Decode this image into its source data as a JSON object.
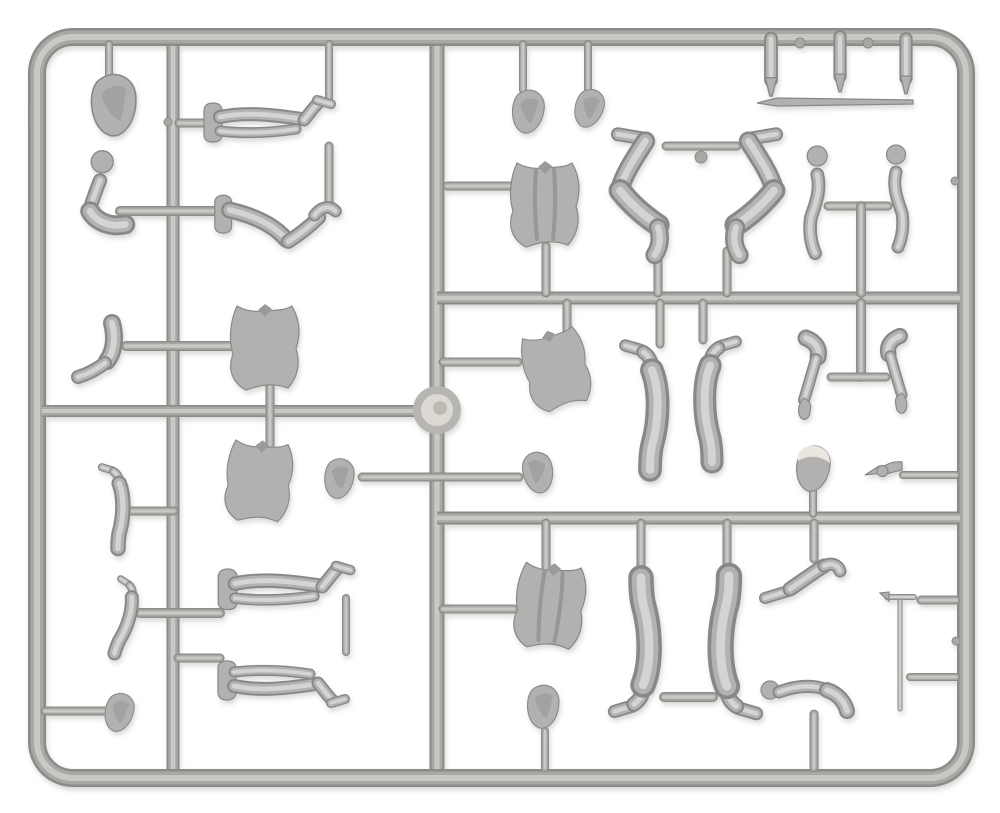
{
  "meta": {
    "title": "Gray plastic model-kit sprue with miniature figure parts",
    "scene_type": "photograph",
    "background_color": "#ffffff"
  },
  "canvas": {
    "width": 1000,
    "height": 813
  },
  "palette": {
    "runner_dark": "#8c8b89",
    "runner_mid": "#a9a8a5",
    "runner_core": "#c9c8c5",
    "part_dark": "#898886",
    "part_mid": "#b3b2b0",
    "part_core": "#d5d4d2",
    "part_fill": "#b2b1af",
    "part_outline": "#8a8987",
    "cap_light": "#eae8e0",
    "disc_ring": "#b6b5b1",
    "disc_center": "#dbd9d1",
    "disc_swirl": "#bdbab0",
    "strap_shade": "#989795",
    "collar_shade": "#9b9a98"
  },
  "frame": {
    "x": 37,
    "y": 37,
    "width": 929,
    "height": 741,
    "radius": 36,
    "thickness": 18
  },
  "runners": [
    {
      "name": "runner-vertical-left",
      "x1": 173,
      "y1": 46,
      "x2": 173,
      "y2": 769,
      "w": 13
    },
    {
      "name": "runner-vertical-center",
      "x1": 437,
      "y1": 46,
      "x2": 437,
      "y2": 769,
      "w": 15
    },
    {
      "name": "runner-horizontal-left-mid",
      "x1": 42,
      "y1": 411,
      "x2": 437,
      "y2": 411,
      "w": 12
    },
    {
      "name": "runner-horizontal-right-upper",
      "x1": 437,
      "y1": 298,
      "x2": 960,
      "y2": 298,
      "w": 13
    },
    {
      "name": "runner-horizontal-right-lower",
      "x1": 437,
      "y1": 518,
      "x2": 960,
      "y2": 518,
      "w": 13
    },
    {
      "name": "gate-arm-left",
      "x1": 120,
      "y1": 211,
      "x2": 222,
      "y2": 211,
      "w": 10,
      "cap": 1
    },
    {
      "name": "gate-boot-torso-left",
      "x1": 126,
      "y1": 346,
      "x2": 230,
      "y2": 346,
      "w": 10,
      "cap": 1
    },
    {
      "name": "gate-legs1-waist",
      "x1": 179,
      "y1": 123,
      "x2": 209,
      "y2": 123,
      "w": 9,
      "cap": 1
    },
    {
      "name": "gate-boot2-left",
      "x1": 122,
      "y1": 511,
      "x2": 174,
      "y2": 511,
      "w": 9,
      "cap": 1
    },
    {
      "name": "gate-legs3-left",
      "x1": 140,
      "y1": 613,
      "x2": 220,
      "y2": 613,
      "w": 10,
      "cap": 1
    },
    {
      "name": "gate-legs4-left",
      "x1": 178,
      "y1": 658,
      "x2": 220,
      "y2": 658,
      "w": 9,
      "cap": 1
    },
    {
      "name": "gate-head-bottom-left",
      "x1": 45,
      "y1": 711,
      "x2": 106,
      "y2": 711,
      "w": 9,
      "cap": 1
    },
    {
      "name": "gate-hooded-head",
      "x1": 109,
      "y1": 44,
      "x2": 109,
      "y2": 76,
      "w": 8,
      "cap": 1
    },
    {
      "name": "gate-legs1-boot-top",
      "x1": 329,
      "y1": 44,
      "x2": 329,
      "y2": 101,
      "w": 8,
      "cap": 1
    },
    {
      "name": "link-legs1-legs2",
      "x1": 329,
      "y1": 146,
      "x2": 329,
      "y2": 204,
      "w": 9,
      "cap": 1
    },
    {
      "name": "gate-torso1-torso2",
      "x1": 270,
      "y1": 386,
      "x2": 270,
      "y2": 450,
      "w": 9,
      "cap": 1
    },
    {
      "name": "link-legs3-legs4",
      "x1": 346,
      "y1": 598,
      "x2": 346,
      "y2": 652,
      "w": 8,
      "cap": 1
    },
    {
      "name": "rod-center-heads",
      "x1": 362,
      "y1": 477,
      "x2": 519,
      "y2": 477,
      "w": 9,
      "cap": 1
    },
    {
      "name": "gate-head1-top",
      "x1": 523,
      "y1": 44,
      "x2": 523,
      "y2": 90,
      "w": 8,
      "cap": 1
    },
    {
      "name": "gate-head2-top",
      "x1": 588,
      "y1": 44,
      "x2": 588,
      "y2": 90,
      "w": 8,
      "cap": 1
    },
    {
      "name": "gate-vest-torso",
      "x1": 447,
      "y1": 186,
      "x2": 513,
      "y2": 186,
      "w": 9,
      "cap": 1
    },
    {
      "name": "gate-vest-down",
      "x1": 546,
      "y1": 246,
      "x2": 546,
      "y2": 293,
      "w": 9,
      "cap": 1
    },
    {
      "name": "bar-bentlegs-feet",
      "x1": 666,
      "y1": 146,
      "x2": 737,
      "y2": 146,
      "w": 9,
      "cap": 1
    },
    {
      "name": "gate-bentleg-left",
      "x1": 658,
      "y1": 251,
      "x2": 658,
      "y2": 293,
      "w": 9,
      "cap": 1
    },
    {
      "name": "gate-bentleg-right",
      "x1": 727,
      "y1": 251,
      "x2": 727,
      "y2": 293,
      "w": 9,
      "cap": 1
    },
    {
      "name": "bar-arms-top",
      "x1": 828,
      "y1": 206,
      "x2": 888,
      "y2": 206,
      "w": 9,
      "cap": 1
    },
    {
      "name": "stub-arms-top",
      "x1": 861,
      "y1": 206,
      "x2": 861,
      "y2": 293,
      "w": 10,
      "cap": 1
    },
    {
      "name": "stub-armsT-below",
      "x1": 861,
      "y1": 303,
      "x2": 861,
      "y2": 377,
      "w": 10,
      "cap": 1
    },
    {
      "name": "bar-armsT-cross",
      "x1": 831,
      "y1": 377,
      "x2": 886,
      "y2": 377,
      "w": 9,
      "cap": 1
    },
    {
      "name": "gate-torsoR1-up",
      "x1": 567,
      "y1": 303,
      "x2": 567,
      "y2": 340,
      "w": 9,
      "cap": 1
    },
    {
      "name": "gate-torsoR1-left",
      "x1": 443,
      "y1": 362,
      "x2": 518,
      "y2": 362,
      "w": 9,
      "cap": 1
    },
    {
      "name": "gate-legR1-up",
      "x1": 660,
      "y1": 303,
      "x2": 660,
      "y2": 344,
      "w": 9,
      "cap": 1
    },
    {
      "name": "gate-legR2-up",
      "x1": 703,
      "y1": 303,
      "x2": 703,
      "y2": 340,
      "w": 9,
      "cap": 1
    },
    {
      "name": "gate-caphead-down",
      "x1": 813,
      "y1": 488,
      "x2": 813,
      "y2": 514,
      "w": 8,
      "cap": 1
    },
    {
      "name": "gate-winged-frame",
      "x1": 903,
      "y1": 475,
      "x2": 956,
      "y2": 475,
      "w": 8,
      "cap": 1
    },
    {
      "name": "gate-torsoR2-up",
      "x1": 546,
      "y1": 523,
      "x2": 546,
      "y2": 574,
      "w": 9,
      "cap": 1
    },
    {
      "name": "gate-torsoR2-left",
      "x1": 443,
      "y1": 609,
      "x2": 514,
      "y2": 609,
      "w": 9,
      "cap": 1
    },
    {
      "name": "gate-legR3-up",
      "x1": 641,
      "y1": 523,
      "x2": 641,
      "y2": 568,
      "w": 9,
      "cap": 1
    },
    {
      "name": "gate-legR4-up",
      "x1": 727,
      "y1": 523,
      "x2": 727,
      "y2": 564,
      "w": 9,
      "cap": 1
    },
    {
      "name": "link-standing-boots",
      "x1": 664,
      "y1": 697,
      "x2": 713,
      "y2": 697,
      "w": 10,
      "cap": 1
    },
    {
      "name": "gate-kneelleg-up",
      "x1": 814,
      "y1": 523,
      "x2": 814,
      "y2": 559,
      "w": 9,
      "cap": 1
    },
    {
      "name": "gate-bentarm-down",
      "x1": 814,
      "y1": 714,
      "x2": 814,
      "y2": 768,
      "w": 9,
      "cap": 1
    },
    {
      "name": "gate-headBC-down",
      "x1": 545,
      "y1": 731,
      "x2": 545,
      "y2": 768,
      "w": 8,
      "cap": 1
    },
    {
      "name": "gate-shovel-frame",
      "x1": 921,
      "y1": 600,
      "x2": 956,
      "y2": 600,
      "w": 9,
      "cap": 1
    },
    {
      "name": "gate-shaft-frame",
      "x1": 910,
      "y1": 677,
      "x2": 956,
      "y2": 677,
      "w": 8,
      "cap": 1
    }
  ],
  "nubs": [
    {
      "name": "frame-nub-top-1",
      "x": 800,
      "y": 43,
      "r": 5
    },
    {
      "name": "frame-nub-top-2",
      "x": 868,
      "y": 43,
      "r": 5
    },
    {
      "name": "frame-nub-right-1",
      "x": 955,
      "y": 181,
      "r": 4
    },
    {
      "name": "frame-nub-right-2",
      "x": 956,
      "y": 641,
      "r": 4
    },
    {
      "name": "runner-nub-left",
      "x": 168,
      "y": 122,
      "r": 4
    },
    {
      "name": "bentlegs-bar-nub",
      "x": 701,
      "y": 157,
      "r": 6
    }
  ],
  "parts": [
    {
      "name": "head-hooded",
      "type": "head",
      "x": 115,
      "y": 104,
      "s": 1.35,
      "rot": -8
    },
    {
      "name": "arm-bent-fist-up-left",
      "type": "armBentUpLeft",
      "x": 100,
      "y": 198,
      "s": 1.1
    },
    {
      "name": "boot-lower-leg-left",
      "type": "bootLeg",
      "x": 105,
      "y": 350,
      "s": 1.0
    },
    {
      "name": "legs-pair-straight-top",
      "type": "legsHU",
      "x": 272,
      "y": 127,
      "s": 1.0
    },
    {
      "name": "legs-pair-bent-sitting",
      "type": "legsBent",
      "x": 282,
      "y": 231,
      "s": 1.05
    },
    {
      "name": "torso-jacket-upper-left",
      "type": "torsoJacket",
      "x": 265,
      "y": 348,
      "s": 1.0
    },
    {
      "name": "torso-jacket-lower-left",
      "type": "torsoJacket",
      "x": 259,
      "y": 482,
      "s": 0.95,
      "rot": 5
    },
    {
      "name": "boot-leg-small-1",
      "type": "legVhang",
      "x": 118,
      "y": 510,
      "s": 0.62
    },
    {
      "name": "boot-leg-small-2",
      "type": "legVhang",
      "x": 124,
      "y": 620,
      "s": 0.56,
      "rot": 16
    },
    {
      "name": "legs-pair-straight-mid",
      "type": "legsHU",
      "x": 289,
      "y": 594,
      "s": 1.04
    },
    {
      "name": "legs-pair-straight-bottom",
      "type": "legsHU",
      "x": 286,
      "y": 676,
      "s": 1.0,
      "my": -1
    },
    {
      "name": "head-small-bottom-left",
      "type": "head",
      "x": 120,
      "y": 712,
      "s": 0.85,
      "rot": 6
    },
    {
      "name": "head-on-rod-left",
      "type": "head",
      "x": 340,
      "y": 478,
      "s": 0.88
    },
    {
      "name": "injection-disc",
      "type": "disc",
      "x": 437,
      "y": 410,
      "s": 1.0
    },
    {
      "name": "head-top-1",
      "type": "head",
      "x": 529,
      "y": 111,
      "s": 0.95
    },
    {
      "name": "head-top-2",
      "type": "head",
      "x": 590,
      "y": 108,
      "s": 0.85,
      "rot": 10
    },
    {
      "name": "cylinder-part-1",
      "type": "cyl",
      "x": 771,
      "y": 65,
      "s": 1.15
    },
    {
      "name": "cylinder-part-2",
      "type": "cyl",
      "x": 840,
      "y": 62,
      "s": 1.1
    },
    {
      "name": "cylinder-part-3",
      "type": "cyl",
      "x": 906,
      "y": 64,
      "s": 1.1
    },
    {
      "name": "thin-rod",
      "type": "rod",
      "x": 835,
      "y": 102,
      "s": 1.0
    },
    {
      "name": "torso-vest",
      "type": "torsoVest",
      "x": 545,
      "y": 205,
      "s": 1.0
    },
    {
      "name": "bent-leg-inverted-left",
      "type": "legZ",
      "x": 650,
      "y": 194,
      "s": 1.15
    },
    {
      "name": "bent-leg-inverted-right",
      "type": "legZ",
      "x": 744,
      "y": 194,
      "s": 1.15,
      "mx": -1
    },
    {
      "name": "arm-fist-up-1",
      "type": "armVup",
      "x": 813,
      "y": 208,
      "s": 1.05
    },
    {
      "name": "arm-fist-up-2",
      "type": "armVup",
      "x": 900,
      "y": 204,
      "s": 1.0,
      "mx": -1
    },
    {
      "name": "torso-jacket-right",
      "type": "torsoJacket",
      "x": 557,
      "y": 370,
      "s": 0.92,
      "rot": -14
    },
    {
      "name": "leg-hanging-left",
      "type": "legVhang",
      "x": 650,
      "y": 411,
      "s": 0.95
    },
    {
      "name": "leg-hanging-right",
      "type": "legVhang",
      "x": 712,
      "y": 405,
      "s": 0.92,
      "mx": -1
    },
    {
      "name": "arm-hanging-left",
      "type": "armHang",
      "x": 809,
      "y": 378,
      "s": 1.0
    },
    {
      "name": "arm-hanging-right",
      "type": "armHang",
      "x": 897,
      "y": 374,
      "s": 0.95,
      "mx": -1
    },
    {
      "name": "head-with-cap",
      "type": "headCap",
      "x": 814,
      "y": 468,
      "s": 1.0
    },
    {
      "name": "winged-part",
      "type": "wing",
      "x": 884,
      "y": 474,
      "s": 1.0
    },
    {
      "name": "head-on-rod-right",
      "type": "head",
      "x": 537,
      "y": 472,
      "s": 0.9,
      "mx": -1
    },
    {
      "name": "torso-vest-bottom",
      "type": "torsoVest",
      "x": 550,
      "y": 607,
      "s": 1.0,
      "rot": 6
    },
    {
      "name": "leg-standing-left",
      "type": "legVhang",
      "x": 641,
      "y": 641,
      "s": 1.02,
      "my": -1
    },
    {
      "name": "leg-standing-right",
      "type": "legVhang",
      "x": 729,
      "y": 641,
      "s": 1.05,
      "mx": -1,
      "my": -1
    },
    {
      "name": "bent-leg-kneeling",
      "type": "kneelLeg",
      "x": 805,
      "y": 581,
      "s": 1.0
    },
    {
      "name": "bent-arm-horizontal",
      "type": "armBentH",
      "x": 810,
      "y": 696,
      "s": 1.0
    },
    {
      "name": "shovel-tool",
      "type": "shovel",
      "x": 902,
      "y": 652,
      "s": 1.0
    },
    {
      "name": "head-bottom-center",
      "type": "head",
      "x": 544,
      "y": 706,
      "s": 0.95,
      "rot": -4
    }
  ]
}
